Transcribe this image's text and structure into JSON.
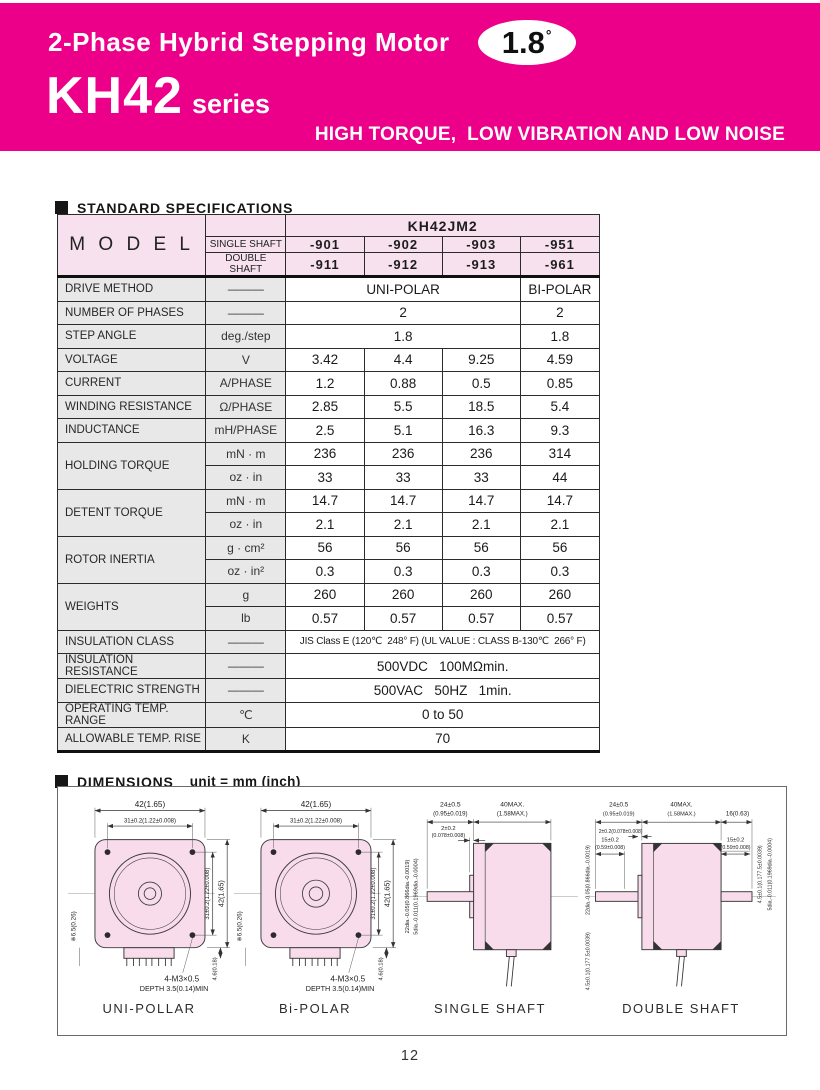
{
  "page": {
    "number": "12"
  },
  "header": {
    "title": "2-Phase Hybrid Stepping Motor",
    "badge_value": "1.8",
    "badge_degree": "°",
    "series_name": "KH42",
    "series_suffix": "series",
    "tagline": "HIGH TORQUE,  LOW VIBRATION AND LOW NOISE",
    "accent_color": "#ec0089"
  },
  "specs": {
    "section_title": "STANDARD SPECIFICATIONS",
    "model_label": "M O D E L",
    "family": "KH42JM2",
    "shaft_rows": [
      {
        "label": "SINGLE SHAFT",
        "models": [
          "-901",
          "-902",
          "-903",
          "-951"
        ]
      },
      {
        "label": "DOUBLE SHAFT",
        "models": [
          "-911",
          "-912",
          "-913",
          "-961"
        ]
      }
    ],
    "rows": [
      {
        "label": "DRIVE METHOD",
        "unit": "———",
        "cells": [
          {
            "t": "UNI-POLAR",
            "s": 3
          },
          {
            "t": "BI-POLAR",
            "s": 1
          }
        ]
      },
      {
        "label": "NUMBER OF PHASES",
        "unit": "———",
        "cells": [
          {
            "t": "2",
            "s": 3
          },
          {
            "t": "2",
            "s": 1
          }
        ]
      },
      {
        "label": "STEP ANGLE",
        "unit": "deg./step",
        "cells": [
          {
            "t": "1.8",
            "s": 3
          },
          {
            "t": "1.8",
            "s": 1
          }
        ]
      },
      {
        "label": "VOLTAGE",
        "unit": "V",
        "cells": [
          {
            "t": "3.42"
          },
          {
            "t": "4.4"
          },
          {
            "t": "9.25"
          },
          {
            "t": "4.59"
          }
        ]
      },
      {
        "label": "CURRENT",
        "unit": "A/PHASE",
        "cells": [
          {
            "t": "1.2"
          },
          {
            "t": "0.88"
          },
          {
            "t": "0.5"
          },
          {
            "t": "0.85"
          }
        ]
      },
      {
        "label": "WINDING RESISTANCE",
        "unit": "Ω/PHASE",
        "cells": [
          {
            "t": "2.85"
          },
          {
            "t": "5.5"
          },
          {
            "t": "18.5"
          },
          {
            "t": "5.4"
          }
        ]
      },
      {
        "label": "INDUCTANCE",
        "unit": "mH/PHASE",
        "cells": [
          {
            "t": "2.5"
          },
          {
            "t": "5.1"
          },
          {
            "t": "16.3"
          },
          {
            "t": "9.3"
          }
        ]
      },
      {
        "label": "HOLDING TORQUE",
        "rowspan": 2,
        "unit": "mN · m",
        "cells": [
          {
            "t": "236"
          },
          {
            "t": "236"
          },
          {
            "t": "236"
          },
          {
            "t": "314"
          }
        ]
      },
      {
        "unit": "oz · in",
        "cells": [
          {
            "t": "33"
          },
          {
            "t": "33"
          },
          {
            "t": "33"
          },
          {
            "t": "44"
          }
        ]
      },
      {
        "label": "DETENT TORQUE",
        "rowspan": 2,
        "unit": "mN · m",
        "cells": [
          {
            "t": "14.7"
          },
          {
            "t": "14.7"
          },
          {
            "t": "14.7"
          },
          {
            "t": "14.7"
          }
        ]
      },
      {
        "unit": "oz · in",
        "cells": [
          {
            "t": "2.1"
          },
          {
            "t": "2.1"
          },
          {
            "t": "2.1"
          },
          {
            "t": "2.1"
          }
        ]
      },
      {
        "label": "ROTOR INERTIA",
        "rowspan": 2,
        "unit": "g · cm²",
        "cells": [
          {
            "t": "56"
          },
          {
            "t": "56"
          },
          {
            "t": "56"
          },
          {
            "t": "56"
          }
        ]
      },
      {
        "unit": "oz · in²",
        "cells": [
          {
            "t": "0.3"
          },
          {
            "t": "0.3"
          },
          {
            "t": "0.3"
          },
          {
            "t": "0.3"
          }
        ]
      },
      {
        "label": "WEIGHTS",
        "rowspan": 2,
        "unit": "g",
        "cells": [
          {
            "t": "260"
          },
          {
            "t": "260"
          },
          {
            "t": "260"
          },
          {
            "t": "260"
          }
        ]
      },
      {
        "unit": "lb",
        "cells": [
          {
            "t": "0.57"
          },
          {
            "t": "0.57"
          },
          {
            "t": "0.57"
          },
          {
            "t": "0.57"
          }
        ]
      },
      {
        "label": "INSULATION CLASS",
        "unit": "———",
        "cells": [
          {
            "t": "JIS Class E (120℃  248° F) (UL VALUE : CLASS B-130℃  266° F)",
            "s": 4,
            "small": true
          }
        ]
      },
      {
        "label": "INSULATION RESISTANCE",
        "unit": "———",
        "cells": [
          {
            "t": "500VDC   100MΩmin.",
            "s": 4
          }
        ]
      },
      {
        "label": "DIELECTRIC STRENGTH",
        "unit": "———",
        "cells": [
          {
            "t": "500VAC   50HZ   1min.",
            "s": 4
          }
        ]
      },
      {
        "label": "OPERATING TEMP. RANGE",
        "unit": "℃",
        "cells": [
          {
            "t": "0 to 50",
            "s": 4
          }
        ]
      },
      {
        "label": "ALLOWABLE TEMP. RISE",
        "unit": "K",
        "cells": [
          {
            "t": "70",
            "s": 4
          }
        ]
      }
    ]
  },
  "dimensions": {
    "section_title": "DIMENSIONS",
    "unit_note": "unit = mm (inch)",
    "captions": [
      "UNI-POLLAR",
      "Bi-POLAR",
      "SINGLE SHAFT",
      "DOUBLE SHAFT"
    ],
    "front": {
      "width": "42(1.65)",
      "hole_pitch": "31±0.2(1.22±0.008)",
      "height": "42(1.65)",
      "hole_pitch_v": "31±0.2(1.22±0.008)",
      "side_ref": "※6.5(0.26)",
      "connector_h": "4.6(0.18)",
      "tap_note1": "4-M3×0.5",
      "tap_note2": "DEPTH 3.5(0.14)MIN"
    },
    "side": {
      "shaft_len": "24±0.5",
      "shaft_len_in": "(0.95±0.019)",
      "body_len": "40MAX.",
      "body_len_in": "(1.58MAX.)",
      "boss_len": "2±0.2",
      "boss_len_in": "(0.078±0.008)",
      "boss_len_full": "2±0.2(0.078±0.008)",
      "shaft_dia": "5dia.-0.011(0.1969dia.-0.0004)",
      "pilot_dia": "22dia.-0.05(0.866dia.-0.0019)",
      "rear_boss": "4.5±0.1(0.177.5±0.0039)",
      "rear_shaft_len": "16(0.63)",
      "shaft_ext": "15±0.2",
      "shaft_ext_in": "(0.59±0.008)"
    }
  }
}
